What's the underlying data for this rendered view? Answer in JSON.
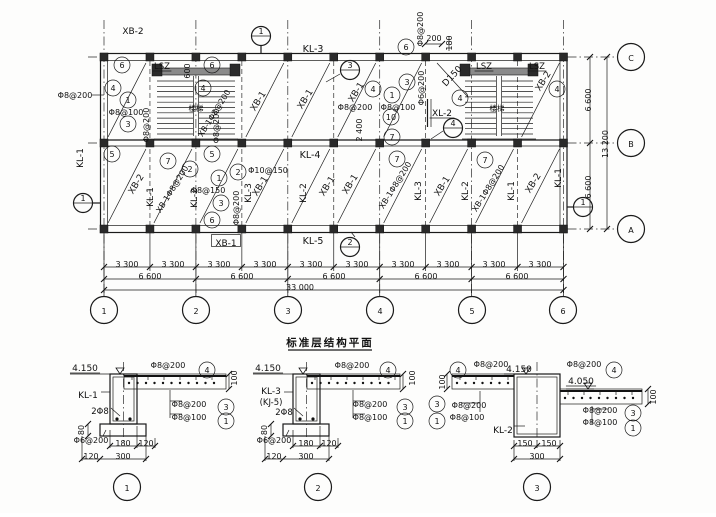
{
  "title": {
    "text": "标准层结构平面"
  },
  "accent_colors": {
    "ink": "#1a1a1a",
    "paper": "#fdfdfc"
  },
  "grid": {
    "column_bubbles": [
      "1",
      "2",
      "3",
      "4",
      "5",
      "6"
    ],
    "row_bubbles": [
      "C",
      "B",
      "A"
    ],
    "bay_dim": "3 300",
    "major_dim": "6 600",
    "total_dim": "33 000",
    "right_dims": [
      "6 600",
      "13 200",
      "6 600"
    ]
  },
  "labels": [
    {
      "n": "label-xb2",
      "t": "XB-2",
      "x": 133,
      "y": 31,
      "s": 9
    },
    {
      "n": "section-marker-1-top",
      "t": "1",
      "x": 261,
      "y": 36,
      "sec": 1
    },
    {
      "n": "label-kl3",
      "t": "KL-3",
      "x": 313,
      "y": 49,
      "s": 9.5
    },
    {
      "n": "callout-6",
      "t": "6",
      "x": 406,
      "y": 47,
      "c": 1
    },
    {
      "n": "label-rebar",
      "t": "Φ8@200",
      "x": 420,
      "y": 29,
      "r": -90
    },
    {
      "n": "dim-200",
      "t": "200",
      "x": 434,
      "y": 38
    },
    {
      "n": "dim-180",
      "t": "180",
      "x": 449,
      "y": 43,
      "r": -90
    },
    {
      "n": "callout-6",
      "t": "6",
      "x": 122,
      "y": 65,
      "c": 1
    },
    {
      "n": "label-lsz",
      "t": "LSZ",
      "x": 162,
      "y": 66,
      "s": 8.5,
      "u": 1
    },
    {
      "n": "dim-600",
      "t": "600",
      "x": 187,
      "y": 71,
      "r": -90
    },
    {
      "n": "callout-6",
      "t": "6",
      "x": 212,
      "y": 65,
      "c": 1
    },
    {
      "n": "callout-4",
      "t": "4",
      "x": 113,
      "y": 88,
      "c": 1
    },
    {
      "n": "callout-4",
      "t": "4",
      "x": 203,
      "y": 88,
      "c": 1
    },
    {
      "n": "callout-1",
      "t": "1",
      "x": 128,
      "y": 100,
      "c": 1
    },
    {
      "n": "label-rebar",
      "t": "Φ8@100",
      "x": 126,
      "y": 112
    },
    {
      "n": "callout-3",
      "t": "3",
      "x": 128,
      "y": 124,
      "c": 1
    },
    {
      "n": "label-rebar",
      "t": "Φ8@200",
      "x": 146,
      "y": 125,
      "r": -90
    },
    {
      "n": "label-stair",
      "t": "楼梯",
      "x": 196,
      "y": 108,
      "s": 7.5
    },
    {
      "n": "label-rebar",
      "t": "Φ8@200",
      "x": 75,
      "y": 95
    },
    {
      "n": "label-rebar",
      "t": "Φ8@200",
      "x": 216,
      "y": 126,
      "r": -90
    },
    {
      "n": "label-xb1-diag",
      "t": "XB-1",
      "x": 258,
      "y": 101,
      "r": -58,
      "s": 9
    },
    {
      "n": "label-xb1-diag",
      "t": "XB-1Φ8@200",
      "x": 214,
      "y": 113,
      "r": -58
    },
    {
      "n": "label-xb1-diag",
      "t": "XB-1",
      "x": 305,
      "y": 99,
      "r": -58,
      "s": 9
    },
    {
      "n": "section-marker-3",
      "t": "3",
      "x": 350,
      "y": 70,
      "sec": 1
    },
    {
      "n": "label-xb1-diag",
      "t": "XB-1",
      "x": 356,
      "y": 92,
      "r": -58,
      "s": 9
    },
    {
      "n": "callout-4",
      "t": "4",
      "x": 373,
      "y": 89,
      "c": 1
    },
    {
      "n": "callout-1",
      "t": "1",
      "x": 392,
      "y": 95,
      "c": 1
    },
    {
      "n": "callout-3",
      "t": "3",
      "x": 407,
      "y": 82,
      "c": 1
    },
    {
      "n": "label-rebar",
      "t": "Φ6@200",
      "x": 421,
      "y": 88,
      "r": -90
    },
    {
      "n": "label-rebar",
      "t": "Φ8@200",
      "x": 355,
      "y": 107
    },
    {
      "n": "label-rebar",
      "t": "Φ8@100",
      "x": 398,
      "y": 107
    },
    {
      "n": "callout-10",
      "t": "10",
      "x": 391,
      "y": 117,
      "c": 1
    },
    {
      "n": "label-xl2",
      "t": "XL-2",
      "x": 442,
      "y": 113,
      "s": 9,
      "u": 1
    },
    {
      "n": "dim-2400",
      "t": "2 400",
      "x": 359,
      "y": 130,
      "r": -90
    },
    {
      "n": "callout-7",
      "t": "7",
      "x": 392,
      "y": 137,
      "c": 1
    },
    {
      "n": "section-marker-4",
      "t": "4",
      "x": 453,
      "y": 128,
      "sec": 1
    },
    {
      "n": "label-d150",
      "t": "D150",
      "x": 452,
      "y": 76,
      "r": -47,
      "s": 9
    },
    {
      "n": "callout-4",
      "t": "4",
      "x": 460,
      "y": 98,
      "c": 1
    },
    {
      "n": "label-lsz",
      "t": "LSZ",
      "x": 484,
      "y": 66,
      "s": 8.5,
      "u": 1
    },
    {
      "n": "label-lsz",
      "t": "LSZ",
      "x": 537,
      "y": 66,
      "s": 8.5,
      "u": 1
    },
    {
      "n": "label-stair",
      "t": "楼梯",
      "x": 497,
      "y": 108,
      "s": 7.5
    },
    {
      "n": "label-xb2-diag",
      "t": "XB-2",
      "x": 543,
      "y": 81,
      "r": -58,
      "s": 9
    },
    {
      "n": "callout-4",
      "t": "4",
      "x": 557,
      "y": 89,
      "c": 1
    },
    {
      "n": "label-kl4",
      "t": "KL-4",
      "x": 310,
      "y": 155,
      "s": 9.5
    },
    {
      "n": "callout-5",
      "t": "5",
      "x": 112,
      "y": 154,
      "c": 1
    },
    {
      "n": "callout-7",
      "t": "7",
      "x": 168,
      "y": 161,
      "c": 1
    },
    {
      "n": "callout-5",
      "t": "5",
      "x": 212,
      "y": 154,
      "c": 1
    },
    {
      "n": "callout-2",
      "t": "2",
      "x": 190,
      "y": 169,
      "c": 1
    },
    {
      "n": "callout-1",
      "t": "1",
      "x": 219,
      "y": 178,
      "c": 1
    },
    {
      "n": "callout-2",
      "t": "2",
      "x": 238,
      "y": 172,
      "c": 1
    },
    {
      "n": "label-rebar",
      "t": "Φ10@150",
      "x": 268,
      "y": 170
    },
    {
      "n": "label-rebar",
      "t": "Φ8@150",
      "x": 208,
      "y": 190
    },
    {
      "n": "callout-3",
      "t": "3",
      "x": 221,
      "y": 203,
      "c": 1
    },
    {
      "n": "callout-6",
      "t": "6",
      "x": 212,
      "y": 220,
      "c": 1
    },
    {
      "n": "label-rebar",
      "t": "Φ8@200",
      "x": 236,
      "y": 208,
      "r": -90
    },
    {
      "n": "callout-7",
      "t": "7",
      "x": 397,
      "y": 159,
      "c": 1
    },
    {
      "n": "callout-7",
      "t": "7",
      "x": 485,
      "y": 160,
      "c": 1
    },
    {
      "n": "label-xb2-diag",
      "t": "XB-2",
      "x": 136,
      "y": 184,
      "r": -58,
      "s": 9
    },
    {
      "n": "label-kl1",
      "t": "KL-1",
      "x": 150,
      "y": 197,
      "r": -90,
      "s": 9
    },
    {
      "n": "label-xb1-diag",
      "t": "XB-1Φ8@200",
      "x": 172,
      "y": 189,
      "r": -58
    },
    {
      "n": "label-kl2",
      "t": "KL-2",
      "x": 194,
      "y": 198,
      "r": -90,
      "s": 9
    },
    {
      "n": "label-kl3",
      "t": "KL-3",
      "x": 248,
      "y": 193,
      "r": -90,
      "s": 9
    },
    {
      "n": "label-xb1-diag",
      "t": "XB-1",
      "x": 260,
      "y": 186,
      "r": -58,
      "s": 9
    },
    {
      "n": "label-kl2",
      "t": "KL-2",
      "x": 303,
      "y": 193,
      "r": -90,
      "s": 9
    },
    {
      "n": "label-xb1-diag",
      "t": "XB-1",
      "x": 327,
      "y": 186,
      "r": -58,
      "s": 9
    },
    {
      "n": "label-xb1-diag",
      "t": "XB-1",
      "x": 350,
      "y": 184,
      "r": -58,
      "s": 9
    },
    {
      "n": "label-xb1-diag",
      "t": "XB-1Φ8@200",
      "x": 395,
      "y": 185,
      "r": -58
    },
    {
      "n": "label-kl3",
      "t": "KL-3",
      "x": 418,
      "y": 191,
      "r": -90,
      "s": 9
    },
    {
      "n": "label-xb1-diag",
      "t": "XB-1",
      "x": 442,
      "y": 186,
      "r": -58,
      "s": 9
    },
    {
      "n": "label-kl2",
      "t": "KL-2",
      "x": 465,
      "y": 191,
      "r": -90,
      "s": 9
    },
    {
      "n": "label-xb1-diag",
      "t": "XB-1Φ8@200",
      "x": 488,
      "y": 188,
      "r": -58
    },
    {
      "n": "label-kl1",
      "t": "KL-1",
      "x": 511,
      "y": 191,
      "r": -90,
      "s": 9
    },
    {
      "n": "label-xb2-diag",
      "t": "XB-2",
      "x": 533,
      "y": 183,
      "r": -58,
      "s": 9
    },
    {
      "n": "label-kl1",
      "t": "KL-1",
      "x": 558,
      "y": 178,
      "r": -90,
      "s": 9
    },
    {
      "n": "label-xb1-boxed",
      "t": "XB-1",
      "x": 226,
      "y": 243,
      "s": 9,
      "b": 1
    },
    {
      "n": "label-kl5",
      "t": "KL-5",
      "x": 313,
      "y": 241,
      "s": 9.5
    },
    {
      "n": "section-marker-2",
      "t": "2",
      "x": 350,
      "y": 247,
      "sec": 1
    },
    {
      "n": "label-kl1",
      "t": "KL-1",
      "x": 80,
      "y": 158,
      "r": -90,
      "s": 9
    },
    {
      "n": "section-marker-1-left",
      "t": "1",
      "x": 83,
      "y": 203,
      "sec": 1
    },
    {
      "n": "section-marker-1-right",
      "t": "1",
      "x": 583,
      "y": 207,
      "sec": 1
    },
    {
      "n": "dim-3300",
      "t": "3 300",
      "x": 127,
      "y": 264
    },
    {
      "n": "dim-3300",
      "t": "3 300",
      "x": 173,
      "y": 264
    },
    {
      "n": "dim-3300",
      "t": "3 300",
      "x": 219,
      "y": 264
    },
    {
      "n": "dim-3300",
      "t": "3 300",
      "x": 265,
      "y": 264
    },
    {
      "n": "dim-3300",
      "t": "3 300",
      "x": 311,
      "y": 264
    },
    {
      "n": "dim-3300",
      "t": "3 300",
      "x": 357,
      "y": 264
    },
    {
      "n": "dim-3300",
      "t": "3 300",
      "x": 403,
      "y": 264
    },
    {
      "n": "dim-3300",
      "t": "3 300",
      "x": 448,
      "y": 264
    },
    {
      "n": "dim-3300",
      "t": "3 300",
      "x": 494,
      "y": 264
    },
    {
      "n": "dim-3300",
      "t": "3 300",
      "x": 540,
      "y": 264
    },
    {
      "n": "dim-6600",
      "t": "6 600",
      "x": 150,
      "y": 276
    },
    {
      "n": "dim-6600",
      "t": "6 600",
      "x": 242,
      "y": 276
    },
    {
      "n": "dim-6600",
      "t": "6 600",
      "x": 334,
      "y": 276
    },
    {
      "n": "dim-6600",
      "t": "6 600",
      "x": 426,
      "y": 276
    },
    {
      "n": "dim-6600",
      "t": "6 600",
      "x": 517,
      "y": 276
    },
    {
      "n": "dim-33000",
      "t": "33 000",
      "x": 300,
      "y": 287
    },
    {
      "n": "grid-bubble-1",
      "t": "1",
      "x": 104,
      "y": 310,
      "c": 2
    },
    {
      "n": "grid-bubble-2",
      "t": "2",
      "x": 196,
      "y": 310,
      "c": 2
    },
    {
      "n": "grid-bubble-3",
      "t": "3",
      "x": 288,
      "y": 310,
      "c": 2
    },
    {
      "n": "grid-bubble-4",
      "t": "4",
      "x": 380,
      "y": 310,
      "c": 2
    },
    {
      "n": "grid-bubble-5",
      "t": "5",
      "x": 472,
      "y": 310,
      "c": 2
    },
    {
      "n": "grid-bubble-6",
      "t": "6",
      "x": 563,
      "y": 310,
      "c": 2
    },
    {
      "n": "dim-6600-right",
      "t": "6 600",
      "x": 588,
      "y": 100,
      "r": -90
    },
    {
      "n": "dim-13200-right",
      "t": "13 200",
      "x": 605,
      "y": 144,
      "r": -90
    },
    {
      "n": "dim-6600-right",
      "t": "6 600",
      "x": 588,
      "y": 187,
      "r": -90
    },
    {
      "n": "grid-bubble-c",
      "t": "C",
      "x": 631,
      "y": 57,
      "c": 2
    },
    {
      "n": "grid-bubble-b",
      "t": "B",
      "x": 631,
      "y": 143,
      "c": 2
    },
    {
      "n": "grid-bubble-a",
      "t": "A",
      "x": 631,
      "y": 229,
      "c": 2
    },
    {
      "n": "level-mark",
      "t": "4.150",
      "x": 85,
      "y": 368,
      "s": 9,
      "u": 1
    },
    {
      "n": "label-kl1",
      "t": "KL-1",
      "x": 88,
      "y": 395,
      "s": 9
    },
    {
      "n": "label-rebar",
      "t": "2Φ8",
      "x": 100,
      "y": 411,
      "s": 8.5
    },
    {
      "n": "dim-80",
      "t": "80",
      "x": 81,
      "y": 430,
      "r": -90
    },
    {
      "n": "label-rebar",
      "t": "Φ6@200",
      "x": 91,
      "y": 440
    },
    {
      "n": "dim-180",
      "t": "180",
      "x": 123,
      "y": 443
    },
    {
      "n": "dim-120",
      "t": "120",
      "x": 146,
      "y": 443
    },
    {
      "n": "dim-120",
      "t": "120",
      "x": 91,
      "y": 456
    },
    {
      "n": "dim-300",
      "t": "300",
      "x": 123,
      "y": 456
    },
    {
      "n": "label-rebar",
      "t": "Φ8@200",
      "x": 168,
      "y": 365
    },
    {
      "n": "callout-4",
      "t": "4",
      "x": 207,
      "y": 370,
      "c": 1
    },
    {
      "n": "dim-100",
      "t": "100",
      "x": 234,
      "y": 378,
      "r": -90
    },
    {
      "n": "label-rebar",
      "t": "Φ8@200",
      "x": 189,
      "y": 404
    },
    {
      "n": "callout-3",
      "t": "3",
      "x": 226,
      "y": 407,
      "c": 1
    },
    {
      "n": "label-rebar",
      "t": "Φ8@100",
      "x": 189,
      "y": 417
    },
    {
      "n": "callout-1",
      "t": "1",
      "x": 226,
      "y": 421,
      "c": 1
    },
    {
      "n": "detail-bubble-1",
      "t": "1",
      "x": 127,
      "y": 487,
      "c": 2
    },
    {
      "n": "level-mark",
      "t": "4.150",
      "x": 268,
      "y": 368,
      "s": 9,
      "u": 1
    },
    {
      "n": "label-kl3",
      "t": "KL-3",
      "x": 271,
      "y": 391,
      "s": 9
    },
    {
      "n": "label-kj5",
      "t": "(KJ-5)",
      "x": 271,
      "y": 402,
      "s": 8.5
    },
    {
      "n": "label-rebar",
      "t": "2Φ8",
      "x": 284,
      "y": 412,
      "s": 8.5
    },
    {
      "n": "dim-80",
      "t": "80",
      "x": 264,
      "y": 430,
      "r": -90
    },
    {
      "n": "label-rebar",
      "t": "Φ6@200",
      "x": 274,
      "y": 440
    },
    {
      "n": "dim-180",
      "t": "180",
      "x": 306,
      "y": 443
    },
    {
      "n": "dim-120",
      "t": "120",
      "x": 329,
      "y": 443
    },
    {
      "n": "dim-120",
      "t": "120",
      "x": 274,
      "y": 456
    },
    {
      "n": "dim-300",
      "t": "300",
      "x": 306,
      "y": 456
    },
    {
      "n": "label-rebar",
      "t": "Φ8@200",
      "x": 352,
      "y": 365
    },
    {
      "n": "callout-4",
      "t": "4",
      "x": 388,
      "y": 370,
      "c": 1
    },
    {
      "n": "dim-100",
      "t": "100",
      "x": 412,
      "y": 378,
      "r": -90
    },
    {
      "n": "label-rebar",
      "t": "Φ8@200",
      "x": 370,
      "y": 404
    },
    {
      "n": "callout-3",
      "t": "3",
      "x": 405,
      "y": 407,
      "c": 1
    },
    {
      "n": "label-rebar",
      "t": "Φ8@100",
      "x": 370,
      "y": 417
    },
    {
      "n": "callout-1",
      "t": "1",
      "x": 405,
      "y": 421,
      "c": 1
    },
    {
      "n": "detail-bubble-2",
      "t": "2",
      "x": 318,
      "y": 487,
      "c": 2
    },
    {
      "n": "dim-100",
      "t": "100",
      "x": 442,
      "y": 382,
      "r": -90
    },
    {
      "n": "callout-4",
      "t": "4",
      "x": 458,
      "y": 370,
      "c": 1
    },
    {
      "n": "label-rebar",
      "t": "Φ8@200",
      "x": 491,
      "y": 364
    },
    {
      "n": "level-mark",
      "t": "4.150",
      "x": 519,
      "y": 369,
      "s": 9,
      "u": 1
    },
    {
      "n": "label-rebar",
      "t": "Φ8@200",
      "x": 584,
      "y": 364
    },
    {
      "n": "callout-4",
      "t": "4",
      "x": 614,
      "y": 370,
      "c": 1
    },
    {
      "n": "level-mark",
      "t": "4.050",
      "x": 581,
      "y": 381,
      "s": 9,
      "u": 1
    },
    {
      "n": "dim-100",
      "t": "100",
      "x": 653,
      "y": 397,
      "r": -90
    },
    {
      "n": "callout-3",
      "t": "3",
      "x": 437,
      "y": 404,
      "c": 1
    },
    {
      "n": "label-rebar",
      "t": "Φ8@200",
      "x": 469,
      "y": 405
    },
    {
      "n": "callout-1",
      "t": "1",
      "x": 437,
      "y": 421,
      "c": 1
    },
    {
      "n": "label-rebar",
      "t": "Φ8@100",
      "x": 467,
      "y": 417
    },
    {
      "n": "label-kl2",
      "t": "KL-2",
      "x": 503,
      "y": 430,
      "s": 9
    },
    {
      "n": "label-rebar",
      "t": "Φ8@200",
      "x": 600,
      "y": 410
    },
    {
      "n": "callout-3",
      "t": "3",
      "x": 633,
      "y": 413,
      "c": 1
    },
    {
      "n": "label-rebar",
      "t": "Φ8@100",
      "x": 600,
      "y": 422
    },
    {
      "n": "callout-1",
      "t": "1",
      "x": 633,
      "y": 428,
      "c": 1
    },
    {
      "n": "dim-150",
      "t": "150",
      "x": 525,
      "y": 443
    },
    {
      "n": "dim-150",
      "t": "150",
      "x": 549,
      "y": 443
    },
    {
      "n": "dim-300",
      "t": "300",
      "x": 537,
      "y": 456
    },
    {
      "n": "detail-bubble-3",
      "t": "3",
      "x": 537,
      "y": 487,
      "c": 2
    }
  ]
}
